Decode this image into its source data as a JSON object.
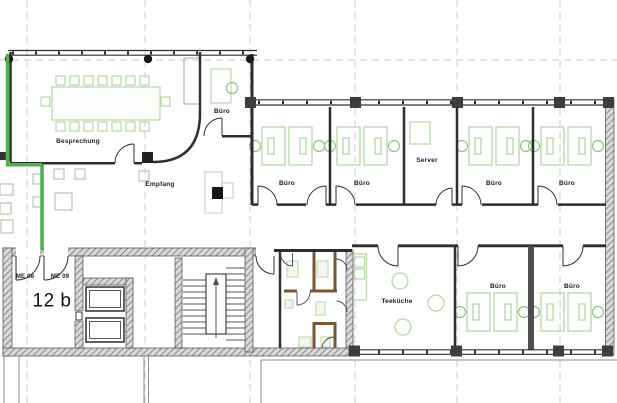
{
  "rooms": {
    "besprechung": {
      "label": "Besprechung"
    },
    "buero_klein": {
      "label": "Büro"
    },
    "empfang": {
      "label": "Empfang"
    },
    "buero_1": {
      "label": "Büro"
    },
    "buero_2": {
      "label": "Büro"
    },
    "server": {
      "label": "Server"
    },
    "buero_3": {
      "label": "Büro"
    },
    "buero_4": {
      "label": "Büro"
    },
    "teekueche": {
      "label": "Teeküche"
    },
    "buero_5": {
      "label": "Büro"
    },
    "buero_6": {
      "label": "Büro"
    }
  },
  "annotations": {
    "unit_label": "12 b",
    "door_me08": "ME 08",
    "door_me09": "ME 09"
  },
  "legend_colors": {
    "existing_wall": "#2e2e2e",
    "green_marking": "#4eb04f",
    "new_wall_brown": "#7a5732",
    "furniture_green": "#b3d8a6",
    "grid": "#cdcdcd"
  }
}
